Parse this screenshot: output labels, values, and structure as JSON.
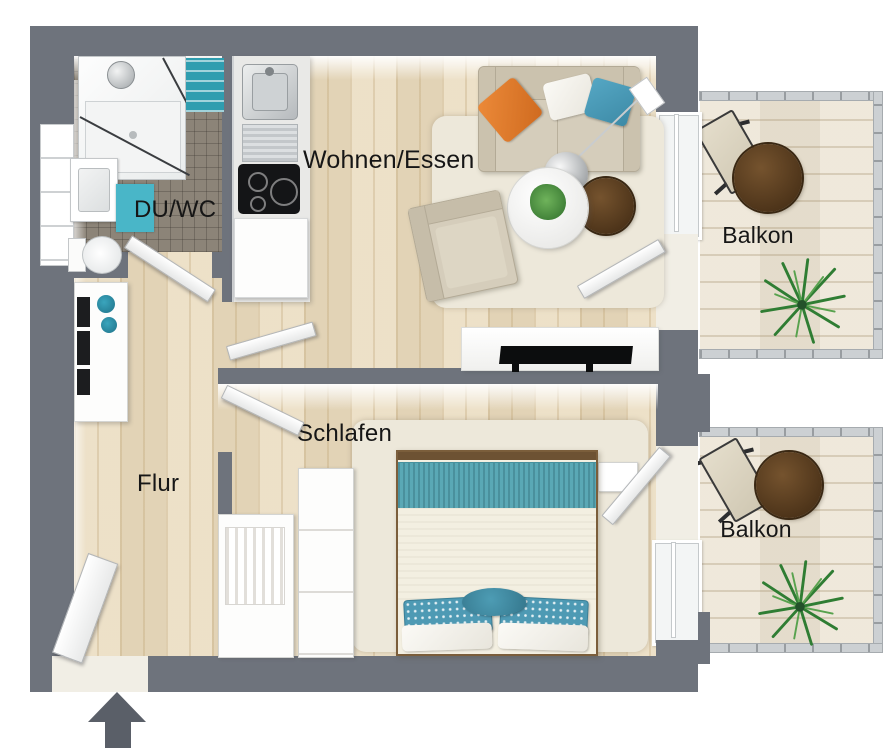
{
  "plan": {
    "type": "apartment-floor-plan-top-view-3d",
    "labels": {
      "bathroom": "DU/WC",
      "living_dining": "Wohnen/Essen",
      "hallway": "Flur",
      "bedroom": "Schlafen",
      "balcony_top": "Balkon",
      "balcony_bottom": "Balkon"
    },
    "icons": {
      "entrance_arrow": "entrance-arrow-up"
    },
    "colors": {
      "wall": "#6e737c",
      "floor_wood": "#e9dabc",
      "balcony_deck": "#ebe3d2",
      "bathroom_tile": "#8c8478",
      "accent_teal": "#4e9ab4",
      "accent_orange": "#e0762c",
      "rug_cream": "#ede8da",
      "table_wood_dark": "#4c3319",
      "entrance_arrow": "#5a5f68"
    },
    "rooms": [
      {
        "name": "bathroom",
        "furniture": [
          "shower",
          "washbasin",
          "toilet",
          "bath-mat",
          "towel-shelf",
          "wall-shelf"
        ]
      },
      {
        "name": "kitchenette",
        "furniture": [
          "sink",
          "drainboard",
          "cooktop",
          "cabinet"
        ]
      },
      {
        "name": "living_dining",
        "furniture": [
          "sofa",
          "orange-pillow",
          "white-pillow",
          "teal-pillow",
          "arc-floor-lamp",
          "coffee-table-white",
          "side-table-wood",
          "potted-plant",
          "armchair",
          "area-rug",
          "tv-sideboard",
          "tv"
        ]
      },
      {
        "name": "bedroom",
        "furniture": [
          "double-bed",
          "teal-bed-runner",
          "patterned-pillows",
          "white-pillows",
          "round-cushion",
          "wardrobe",
          "slatted-closet",
          "nightstand",
          "area-rug"
        ]
      },
      {
        "name": "hallway",
        "furniture": [
          "sideboard",
          "teal-bowls",
          "picture-frames",
          "entrance-door"
        ]
      },
      {
        "name": "balconies",
        "furniture": [
          "round-table",
          "folding-chair",
          "palm-plant",
          "railing"
        ]
      }
    ]
  }
}
